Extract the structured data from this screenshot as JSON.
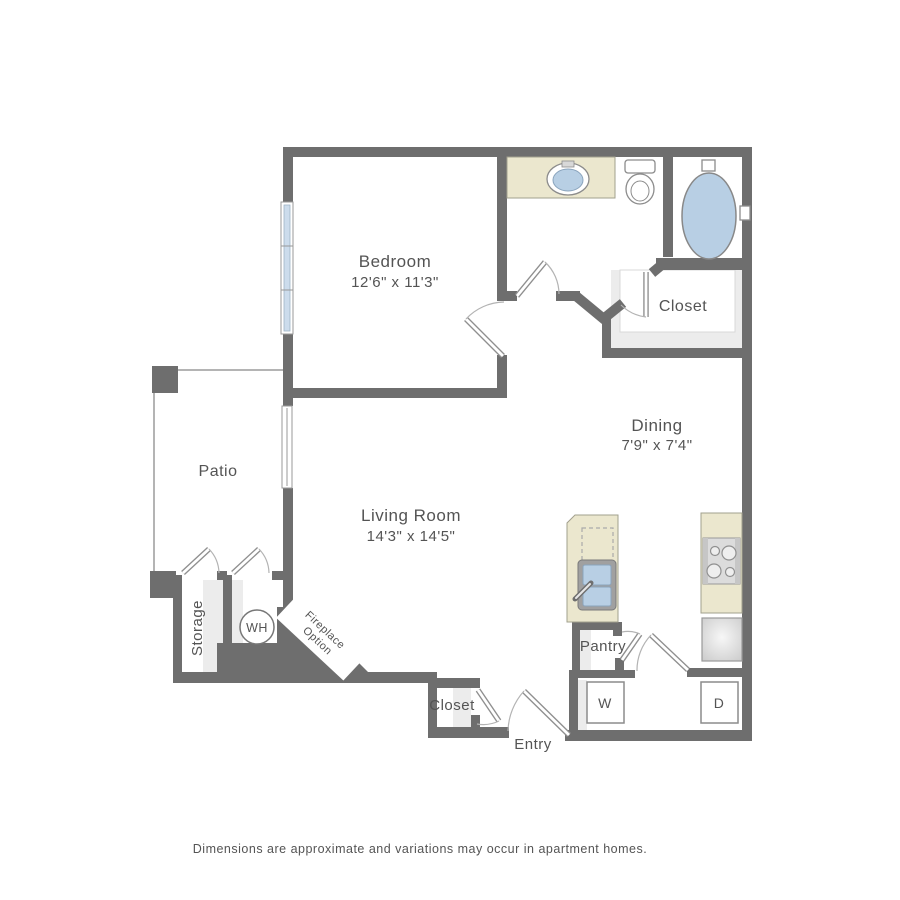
{
  "floor_plan": {
    "rooms": {
      "bedroom": {
        "label": "Bedroom",
        "dimensions": "12'6\" x 11'3\""
      },
      "living_room": {
        "label": "Living Room",
        "dimensions": "14'3\" x 14'5\""
      },
      "dining": {
        "label": "Dining",
        "dimensions": "7'9\" x 7'4\""
      },
      "patio": {
        "label": "Patio"
      },
      "storage": {
        "label": "Storage"
      },
      "bathroom_closet": {
        "label": "Closet"
      },
      "entry_closet": {
        "label": "Closet"
      },
      "pantry": {
        "label": "Pantry"
      },
      "entry": {
        "label": "Entry"
      }
    },
    "appliances": {
      "water_heater": {
        "label": "WH"
      },
      "washer": {
        "label": "W"
      },
      "dryer": {
        "label": "D"
      }
    },
    "options": {
      "fireplace": {
        "label_line1": "Fireplace",
        "label_line2": "Option"
      }
    },
    "footnote": "Dimensions are approximate and variations may occur in apartment homes.",
    "colors": {
      "wall": "#6e6e6e",
      "counter_cream": "#ebe7ce",
      "fixture_blue": "#b8cfe4",
      "floor_shade": "#ececec",
      "appliance_gray": "#d9d9d9",
      "label_text": "#545454"
    }
  }
}
